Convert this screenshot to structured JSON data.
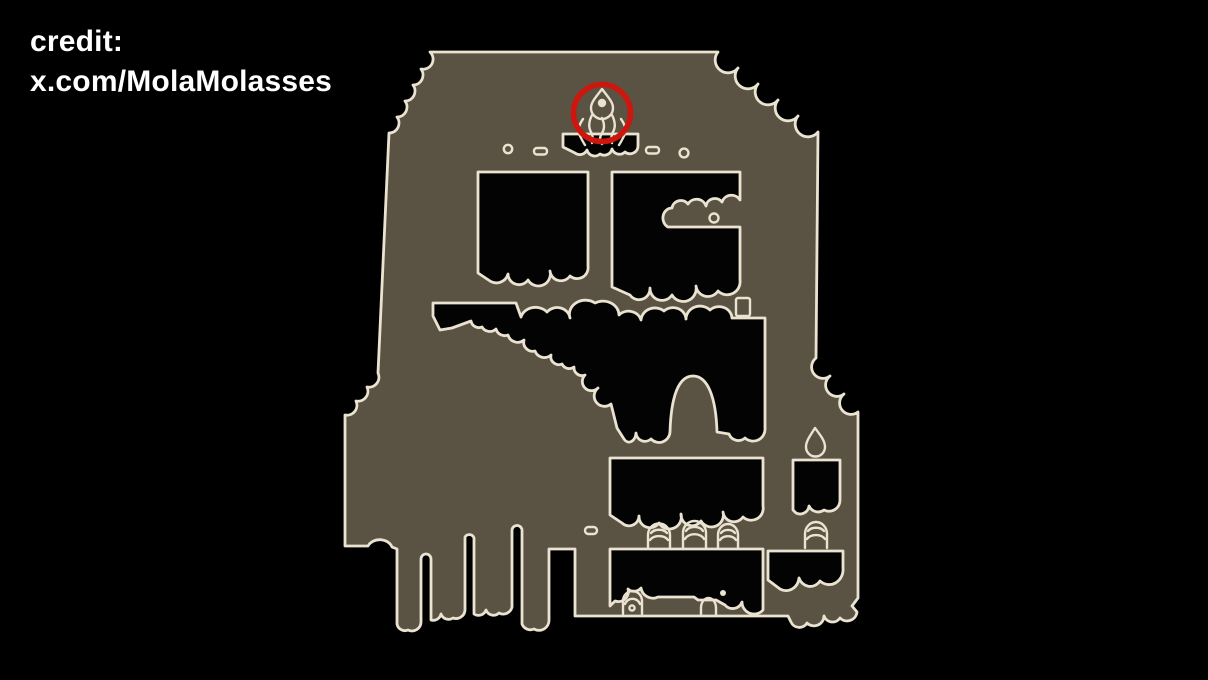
{
  "credit": {
    "line1": "credit:",
    "line2": "x.com/MolaMolasses"
  },
  "map": {
    "description": "Hand-drawn game map silhouette with carved-out rooms",
    "icons": {
      "flame": "flame-icon",
      "flame_highlight": "red-circle-marker",
      "droplet": "droplet-icon",
      "bell": "bell-shrine-icon",
      "tombstones": "arch-stone-icon"
    }
  },
  "colors": {
    "background": "#000000",
    "map_fill": "#5a5243",
    "outline": "#eae3d1",
    "room_fill": "#030303",
    "highlight_red": "#cd170e",
    "text": "#ffffff"
  }
}
